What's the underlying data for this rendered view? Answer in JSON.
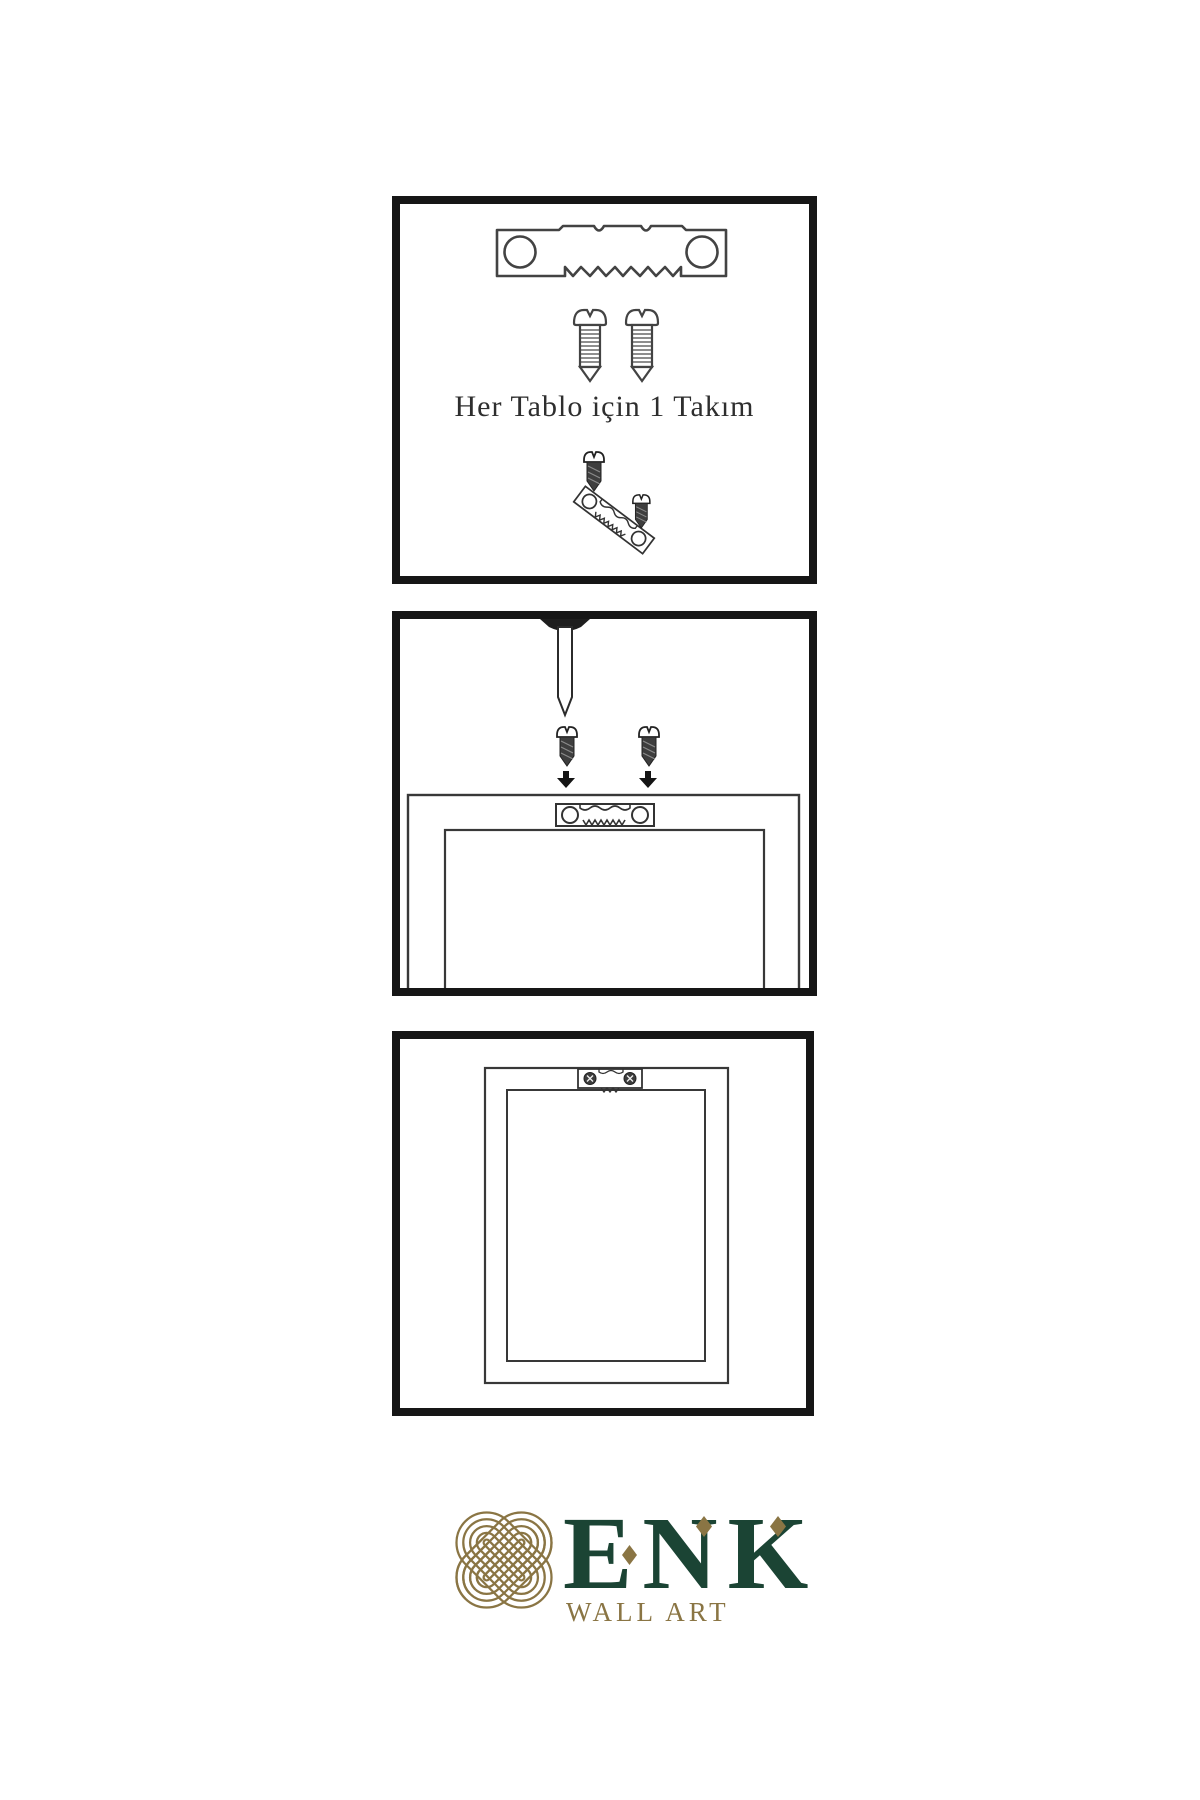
{
  "panels": {
    "panel1": {
      "caption": "Her Tablo için 1 Takım",
      "illustrations": [
        "sawtooth-hanger",
        "screw",
        "screw",
        "dark-screw",
        "tilted-sawtooth-hanger",
        "dark-screw"
      ]
    },
    "panel2": {
      "illustrations": [
        "wall-nail",
        "dark-screw-with-arrow",
        "dark-screw-with-arrow",
        "canvas-frame-back",
        "sawtooth-hanger-on-frame"
      ]
    },
    "panel3": {
      "illustrations": [
        "canvas-frame-back",
        "mounted-sawtooth-hanger-with-screws"
      ]
    }
  },
  "brand": {
    "name": "ENK",
    "subtitle": "WALL ART",
    "colors": {
      "green": "#1b4434",
      "gold": "#8a7544"
    }
  }
}
